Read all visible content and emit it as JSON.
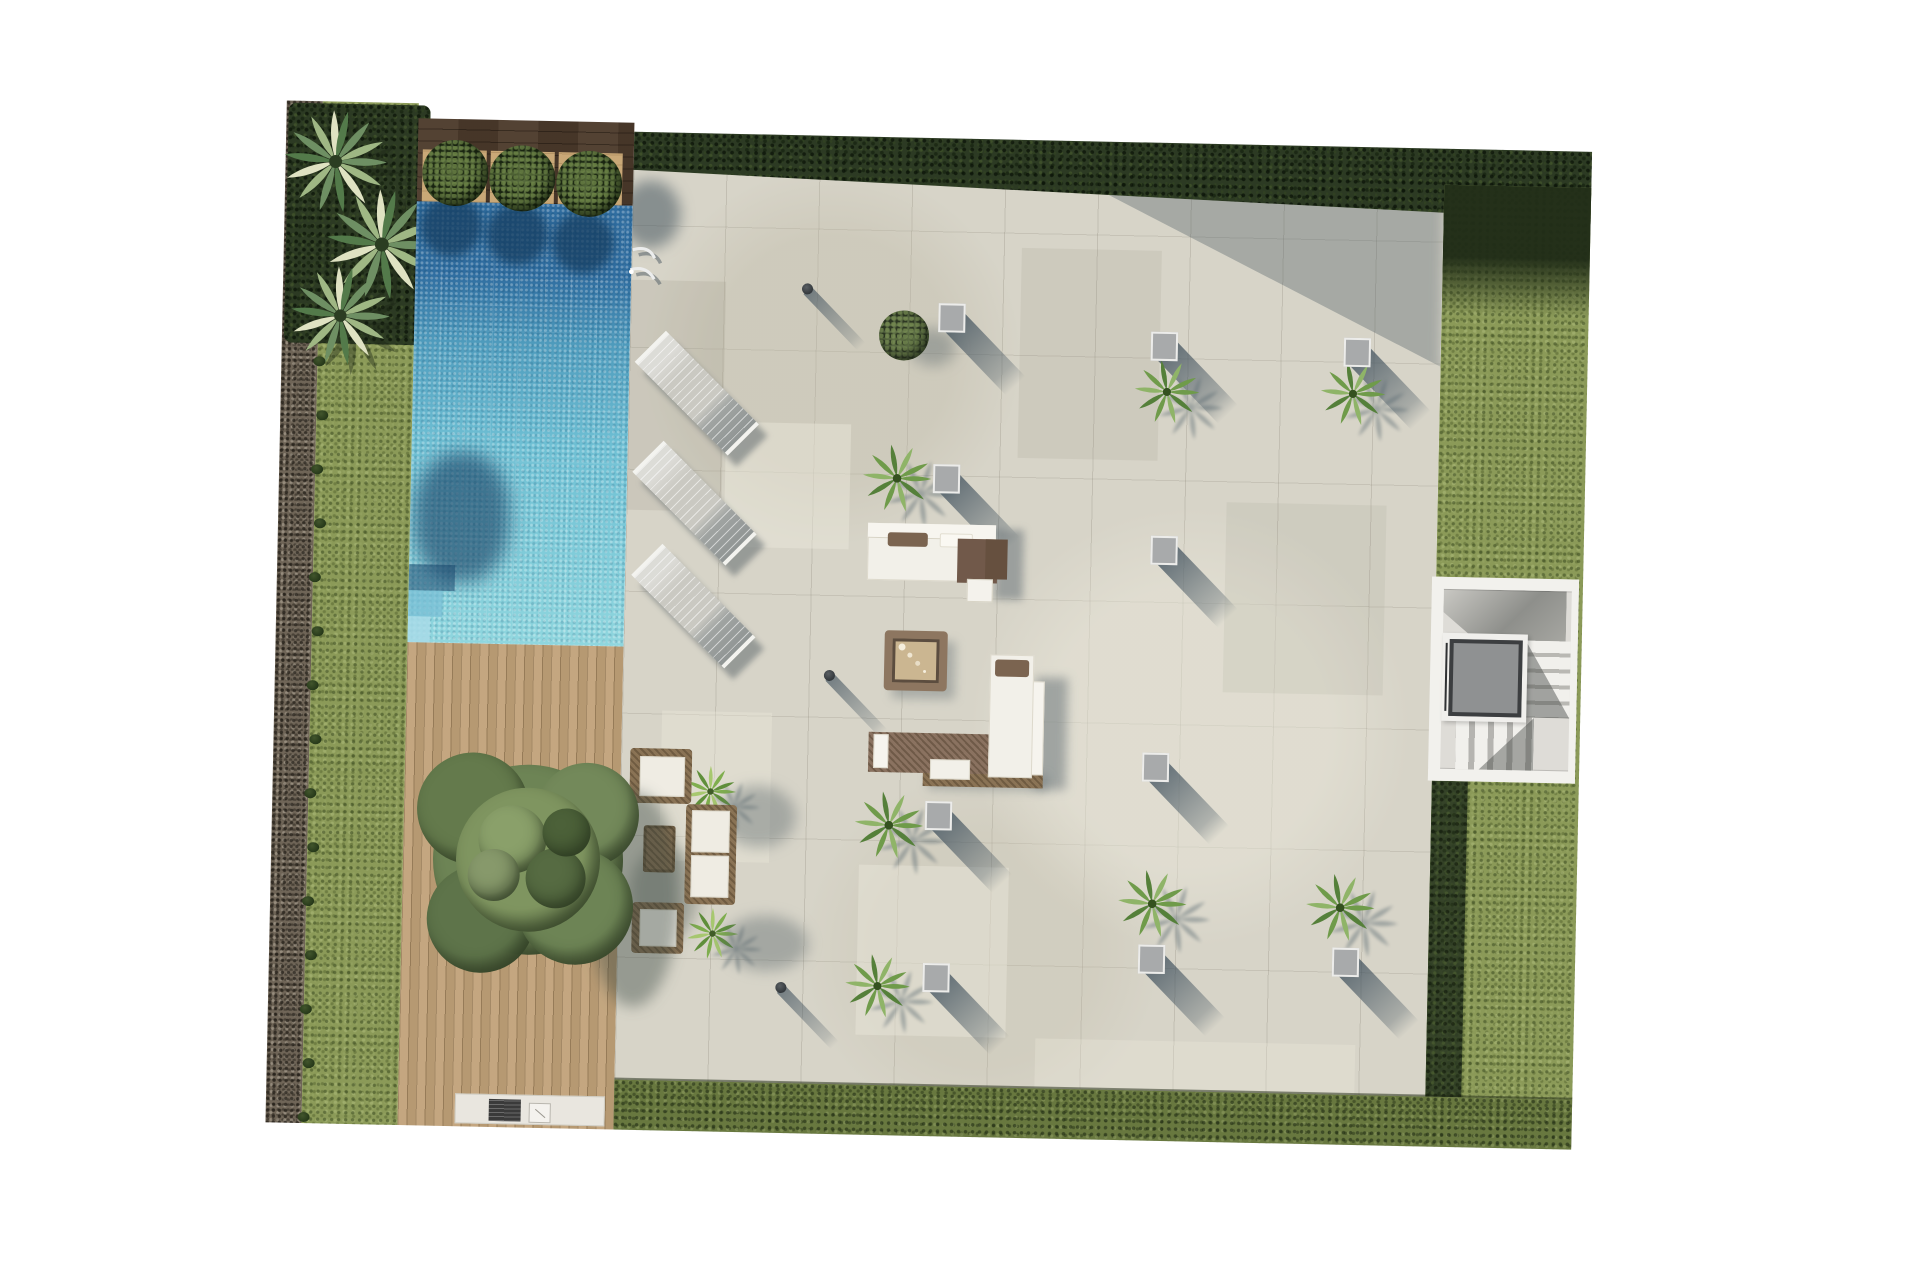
{
  "meta": {
    "title": "Aerial architectural rendering - villa pool terrace plan",
    "canvas": {
      "width": 1920,
      "height": 1280
    },
    "visible_text": "none"
  },
  "palette": {
    "page_background": "#ffffff",
    "pool_deep": "#2f6da0",
    "pool_shallow": "#8fd6de",
    "pool_shadow": "#1d4a70",
    "paving": "#d7d4c8",
    "shadow_slate": "#3e4f5c",
    "grass": "#8b9a58",
    "hedge_dark": "#2c3a23",
    "hedge_mid": "#68783f",
    "gravel": "#6f6557",
    "deck_wood": "#c0a178",
    "planter_wood": "#4c3a2b",
    "planter_pad_tan": "#c9a877",
    "bush_green": "#3d4f2b",
    "palm_green": "#6f9b4a",
    "furniture_white": "#f2f0e9",
    "furniture_brown": "#7b6450",
    "planter_gray": "#a8aaab",
    "stairs_light": "#dedcd7",
    "elevator_gray": "#8f9192",
    "elevator_frame_dark": "#3c3e40"
  },
  "scene": {
    "regions": [
      {
        "name": "gravel-path-strip"
      },
      {
        "name": "left-lawn-strip"
      },
      {
        "name": "palm-planting-bed"
      },
      {
        "name": "planter-wood-strip"
      },
      {
        "name": "swimming-pool"
      },
      {
        "name": "timber-deck"
      },
      {
        "name": "paved-terrace"
      },
      {
        "name": "top-hedge"
      },
      {
        "name": "right-lawn-strip"
      },
      {
        "name": "bottom-hedge-strip"
      },
      {
        "name": "staircase-block"
      }
    ],
    "boxwood_bushes": [
      {
        "cx": 174,
        "cy": 69,
        "r": 33,
        "pad_x": 141
      },
      {
        "cx": 241,
        "cy": 73,
        "r": 33,
        "pad_x": 209
      },
      {
        "cx": 308,
        "cy": 77,
        "r": 33,
        "pad_x": 277
      }
    ],
    "pool": {
      "bush_shadows": [
        {
          "x": 35,
          "y": 24,
          "r": 31
        },
        {
          "x": 101,
          "y": 31,
          "r": 31
        },
        {
          "x": 167,
          "y": 38,
          "r": 31
        }
      ],
      "tree_shadow": {
        "x": 4,
        "y": 250,
        "w": 95,
        "h": 130
      },
      "corner_steps": 3,
      "ladder": true
    },
    "fan_palms": [
      {
        "x": 48,
        "y": 58,
        "r": 54
      },
      {
        "x": 96,
        "y": 140,
        "r": 58
      },
      {
        "x": 56,
        "y": 212,
        "r": 52
      }
    ],
    "lawn_tufts": {
      "x": 36,
      "y_start": 255,
      "y_step": 54,
      "count": 15
    },
    "terrace": {
      "planter_boxes": [
        {
          "x": 321,
          "y": 141
        },
        {
          "x": 534,
          "y": 165
        },
        {
          "x": 727,
          "y": 167
        },
        {
          "x": 319,
          "y": 302
        },
        {
          "x": 538,
          "y": 369
        },
        {
          "x": 534,
          "y": 586
        },
        {
          "x": 318,
          "y": 639
        },
        {
          "x": 319,
          "y": 801
        },
        {
          "x": 534,
          "y": 778
        },
        {
          "x": 728,
          "y": 777
        }
      ],
      "small_palms": [
        {
          "x": 538,
          "y": 211,
          "r": 34
        },
        {
          "x": 724,
          "y": 209,
          "r": 34
        },
        {
          "x": 270,
          "y": 303,
          "r": 36
        },
        {
          "x": 269,
          "y": 650,
          "r": 36
        },
        {
          "x": 534,
          "y": 723,
          "r": 36
        },
        {
          "x": 722,
          "y": 723,
          "r": 36
        },
        {
          "x": 261,
          "y": 811,
          "r": 34
        }
      ],
      "feature_bush": {
        "x": 274,
        "y": 160,
        "r": 25
      },
      "bollard_lights": [
        {
          "x": 176,
          "y": 115
        },
        {
          "x": 206,
          "y": 501
        },
        {
          "x": 164,
          "y": 814
        }
      ],
      "sun_loungers": [
        {
          "x": 68,
          "y": 222
        },
        {
          "x": 68,
          "y": 332
        },
        {
          "x": 69,
          "y": 435
        }
      ],
      "accent_plants": [
        {
          "x": 90,
          "y": 620,
          "r": 27
        },
        {
          "x": 95,
          "y": 762,
          "r": 27
        }
      ],
      "tile_patches": [
        {
          "x": 0,
          "y": 110,
          "w": 95,
          "h": 230,
          "c": "rgba(148,143,126,0.18)"
        },
        {
          "x": 98,
          "y": 250,
          "w": 125,
          "h": 125,
          "c": "rgba(236,233,220,0.45)"
        },
        {
          "x": 390,
          "y": 70,
          "w": 140,
          "h": 210,
          "c": "rgba(150,145,128,0.14)"
        },
        {
          "x": 240,
          "y": 690,
          "w": 150,
          "h": 170,
          "c": "rgba(238,235,222,0.4)"
        },
        {
          "x": 600,
          "y": 320,
          "w": 160,
          "h": 190,
          "c": "rgba(150,145,128,0.12)"
        },
        {
          "x": 40,
          "y": 540,
          "w": 110,
          "h": 150,
          "c": "rgba(238,235,222,0.35)"
        },
        {
          "x": 420,
          "y": 860,
          "w": 320,
          "h": 60,
          "c": "rgba(238,235,222,0.3)"
        }
      ]
    },
    "furniture": {
      "sofa_set_top": {
        "x": 242,
        "y": 348,
        "style": "white sectional with brown chaise"
      },
      "sofa_set_l_shape": {
        "x": 247,
        "y": 477,
        "style": "L-shaped white and brown sectional"
      },
      "fire_table": {
        "x": 261,
        "y": 455,
        "candles": 4
      },
      "lounge_group": {
        "x": 6,
        "y": 565,
        "pieces": [
          "armchair",
          "armchair",
          "sofa",
          "side-table"
        ]
      },
      "bbq_counter": {
        "x": 193,
        "y": 989,
        "w": 150,
        "h": 30
      }
    },
    "large_tree": {
      "cx": 261,
      "cy": 754,
      "r": 112
    },
    "stairs": {
      "x": 1159,
      "y": 452,
      "w": 147,
      "h": 204,
      "elevator": {
        "x": 1178,
        "y": 514,
        "w": 73,
        "h": 77
      }
    }
  }
}
